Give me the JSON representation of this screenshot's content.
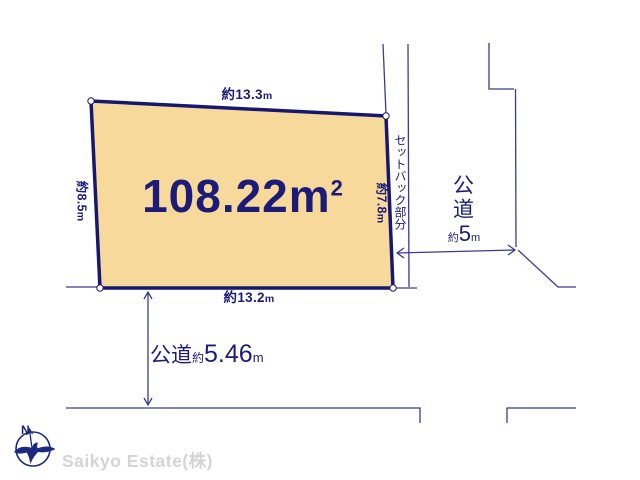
{
  "colors": {
    "plot_fill": "#f7d99b",
    "outline": "#171770",
    "thin_line": "#3b3b8b",
    "text": "#1c1c78",
    "watermark_text": "#d4d4d4"
  },
  "plot": {
    "area": {
      "value": "108.22",
      "unit": "m",
      "sup": "2"
    }
  },
  "dimensions": {
    "top": {
      "value": "約13.3",
      "unit": "m"
    },
    "bottom": {
      "value": "約13.2",
      "unit": "m"
    },
    "left": {
      "value": "約8.5",
      "unit": "m"
    },
    "right": {
      "value": "約7.8",
      "unit": "m"
    }
  },
  "setback": {
    "label": "セットバック部分"
  },
  "roads": {
    "right": {
      "name": "公道",
      "approx": "約",
      "width": "5",
      "unit": "m"
    },
    "bottom": {
      "name": "公道",
      "approx": "約",
      "width": "5.46",
      "unit": "m"
    }
  },
  "compass": {
    "north": "N"
  },
  "credit": {
    "label": "Saikyo Estate(株)"
  }
}
